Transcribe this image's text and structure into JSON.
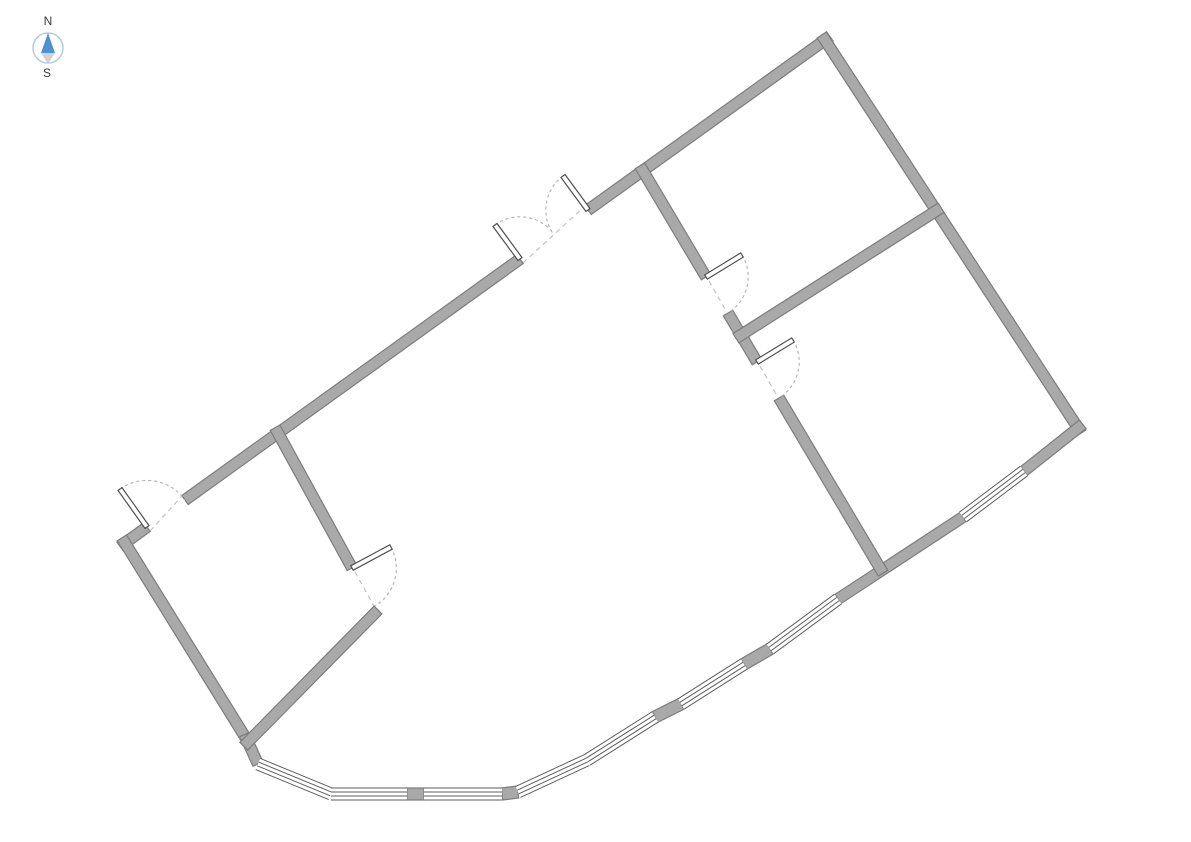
{
  "canvas": {
    "width": 1191,
    "height": 842,
    "background": "#ffffff"
  },
  "compass": {
    "north_label": "N",
    "south_label": "S",
    "cx": 48,
    "cy": 48,
    "radius": 15,
    "ring_color": "#a9c6df",
    "north_arrow_color": "#4e92d1",
    "south_arrow_color": "#d2d2d2",
    "label_color": "#3a3a3a"
  },
  "plan": {
    "wall_thickness": 11,
    "window_thickness": 12,
    "corner_extension": 6,
    "colors": {
      "wall_fill": "#a9a9a9",
      "wall_edge": "#7d7d7d",
      "window_fill": "#ffffff",
      "window_line": "#5e5e5e",
      "door_leaf_fill": "#ffffff",
      "door_leaf_edge": "#4f4f4f",
      "door_arc": "#b0b0b0",
      "opening_line": "#c4c4c4"
    },
    "walls": [
      {
        "name": "exterior-wall-nw-corner-stub",
        "x1": 125,
        "y1": 543,
        "x2": 147,
        "y2": 527,
        "ext1": true,
        "ext2": false
      },
      {
        "name": "exterior-wall-nw-main",
        "x1": 185,
        "y1": 500,
        "x2": 520,
        "y2": 259,
        "ext1": false,
        "ext2": false
      },
      {
        "name": "exterior-wall-nw-upper",
        "x1": 588,
        "y1": 210,
        "x2": 825,
        "y2": 40,
        "ext1": false,
        "ext2": true
      },
      {
        "name": "exterior-wall-ne",
        "x1": 825,
        "y1": 40,
        "x2": 1078,
        "y2": 428,
        "ext1": true,
        "ext2": true
      },
      {
        "name": "exterior-wall-se-upper-stub",
        "x1": 1078,
        "y1": 428,
        "x2": 1024,
        "y2": 471,
        "ext1": true,
        "ext2": false
      },
      {
        "name": "exterior-wall-se-mid",
        "x1": 963,
        "y1": 517,
        "x2": 838,
        "y2": 599,
        "ext1": false,
        "ext2": false
      },
      {
        "name": "exterior-wall-sw",
        "x1": 125,
        "y1": 543,
        "x2": 247,
        "y2": 740,
        "ext1": true,
        "ext2": true
      },
      {
        "name": "exterior-wall-sw-stub",
        "x1": 247,
        "y1": 740,
        "x2": 258,
        "y2": 764,
        "ext1": true,
        "ext2": false
      },
      {
        "name": "facade-pillar-1",
        "x1": 407,
        "y1": 794,
        "x2": 424,
        "y2": 794,
        "ext1": false,
        "ext2": false,
        "t": 12
      },
      {
        "name": "facade-pillar-2",
        "x1": 502,
        "y1": 794,
        "x2": 518,
        "y2": 792,
        "ext1": false,
        "ext2": false,
        "t": 12
      },
      {
        "name": "facade-pillar-3",
        "x1": 655,
        "y1": 717,
        "x2": 681,
        "y2": 704,
        "ext1": false,
        "ext2": false,
        "t": 12
      },
      {
        "name": "facade-pillar-4",
        "x1": 744,
        "y1": 664,
        "x2": 770,
        "y2": 649,
        "ext1": false,
        "ext2": false,
        "t": 12
      },
      {
        "name": "interior-wall-small-room-ne",
        "x1": 278,
        "y1": 433,
        "x2": 352,
        "y2": 568,
        "ext1": true,
        "ext2": false
      },
      {
        "name": "interior-wall-small-room-se",
        "x1": 378,
        "y1": 610,
        "x2": 248,
        "y2": 742,
        "ext1": false,
        "ext2": true
      },
      {
        "name": "interior-wall-central-upper",
        "x1": 643,
        "y1": 171,
        "x2": 706,
        "y2": 277,
        "ext1": true,
        "ext2": false
      },
      {
        "name": "interior-wall-central-mid",
        "x1": 728,
        "y1": 313,
        "x2": 757,
        "y2": 362,
        "ext1": false,
        "ext2": false
      },
      {
        "name": "interior-wall-central-lower",
        "x1": 779,
        "y1": 398,
        "x2": 880,
        "y2": 568,
        "ext1": false,
        "ext2": true
      },
      {
        "name": "interior-wall-right-divider",
        "x1": 741,
        "y1": 335,
        "x2": 936,
        "y2": 211,
        "ext1": true,
        "ext2": true
      }
    ],
    "windows": [
      {
        "name": "facade-window-1",
        "x1": 258,
        "y1": 764,
        "x2": 331,
        "y2": 794
      },
      {
        "name": "facade-window-2",
        "x1": 331,
        "y1": 794,
        "x2": 407,
        "y2": 794
      },
      {
        "name": "facade-window-3",
        "x1": 424,
        "y1": 794,
        "x2": 502,
        "y2": 794
      },
      {
        "name": "facade-window-4",
        "x1": 518,
        "y1": 792,
        "x2": 587,
        "y2": 760
      },
      {
        "name": "facade-window-5",
        "x1": 587,
        "y1": 760,
        "x2": 655,
        "y2": 717
      },
      {
        "name": "facade-window-6",
        "x1": 681,
        "y1": 704,
        "x2": 744,
        "y2": 664
      },
      {
        "name": "facade-window-7",
        "x1": 770,
        "y1": 649,
        "x2": 838,
        "y2": 599
      },
      {
        "name": "facade-window-8",
        "x1": 963,
        "y1": 517,
        "x2": 1024,
        "y2": 471
      }
    ],
    "doors": [
      {
        "name": "entry-door-west",
        "hinge": [
          147,
          527
        ],
        "tip": [
          120,
          489
        ],
        "end": [
          185,
          500
        ]
      },
      {
        "name": "double-door-north-left",
        "hinge": [
          520,
          259
        ],
        "tip": [
          495,
          225
        ],
        "end": [
          554,
          234
        ]
      },
      {
        "name": "double-door-north-right",
        "hinge": [
          588,
          210
        ],
        "tip": [
          563,
          176
        ],
        "end": [
          554,
          234
        ]
      },
      {
        "name": "small-room-door",
        "hinge": [
          352,
          568
        ],
        "tip": [
          391,
          547
        ],
        "end": [
          377,
          610
        ]
      },
      {
        "name": "upper-right-room-door",
        "hinge": [
          706,
          277
        ],
        "tip": [
          742,
          255
        ],
        "end": [
          728,
          313
        ]
      },
      {
        "name": "lower-right-room-door",
        "hinge": [
          757,
          362
        ],
        "tip": [
          793,
          340
        ],
        "end": [
          779,
          398
        ]
      }
    ],
    "openings": [
      {
        "name": "opening-entry-west",
        "x1": 150,
        "y1": 531,
        "x2": 182,
        "y2": 496
      },
      {
        "name": "opening-double-door-north",
        "x1": 523,
        "y1": 263,
        "x2": 585,
        "y2": 206
      },
      {
        "name": "opening-small-room",
        "x1": 355,
        "y1": 572,
        "x2": 374,
        "y2": 606
      },
      {
        "name": "opening-upper-right-room",
        "x1": 709,
        "y1": 281,
        "x2": 725,
        "y2": 309
      },
      {
        "name": "opening-lower-right-room",
        "x1": 760,
        "y1": 366,
        "x2": 776,
        "y2": 394
      }
    ]
  }
}
